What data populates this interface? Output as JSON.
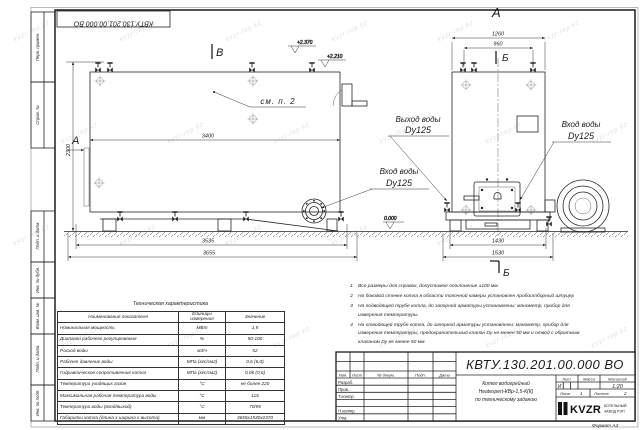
{
  "watermark": {
    "text": "kvzr-rep.kz"
  },
  "frame": {
    "stamp": "КВТУ.130.201.00.000  ВО",
    "margin_labels": [
      "Перв. примен.",
      "Справ. №",
      "Подп. и дата",
      "Инв. № дубл.",
      "Взам. инв. №",
      "Подп. и дата",
      "Инв. № подл."
    ],
    "format_label": "Формат  А3"
  },
  "drawing": {
    "sections": {
      "a_front": "А",
      "b_front": "В",
      "a_rear": "А",
      "b_top": "Б",
      "b_bottom": "Б"
    },
    "note_ref": "см. п. 2",
    "elevations": {
      "top1": "+2.370",
      "top2": "+2.210",
      "zero": "0.000"
    },
    "dims": {
      "front_width": "3400",
      "front_height": "2300",
      "front_base_inner": "3535",
      "front_base_outer": "3655",
      "rear_width": "1260",
      "rear_inner": "960",
      "rear_base_inner": "1430",
      "rear_base_outer": "1530"
    },
    "ports": {
      "outlet_line1": "Выход воды",
      "outlet_line2": "Dy125",
      "inlet_front_line1": "Вход воды",
      "inlet_front_line2": "Dy125",
      "inlet_rear_line1": "Вход воды",
      "inlet_rear_line2": "Dy125"
    }
  },
  "tech_table": {
    "title": "Техническая характеристика",
    "headers": [
      "Наименование показателя",
      "Единицы измерения",
      "Значение"
    ],
    "rows": [
      [
        "Номинальная мощность",
        "МВт",
        "1,5"
      ],
      [
        "Диапазон рабочего регулирования",
        "%",
        "50-100"
      ],
      [
        "Расход воды",
        "м3/ч",
        "52"
      ],
      [
        "Рабочее давление воды",
        "МПа (кгс/см2)",
        "0,6 (6,0)"
      ],
      [
        "Гидравлическое сопротивление котла",
        "МПа (кгс/см2)",
        "0,06 (0,6)"
      ],
      [
        "Температура уходящих газов",
        "°С",
        "не более 220"
      ],
      [
        "Максимальная рабочая температура воды",
        "°С",
        "115"
      ],
      [
        "Температура воды (вход/выход)",
        "°С",
        "70/95"
      ],
      [
        "Габариты котла (длина х ширина х высота)",
        "мм",
        "3655х1530х2370"
      ]
    ]
  },
  "notes": {
    "items": [
      "Все размеры для справок, допустимое отклонение ±100 мм.",
      "На боковой стенке котла в области топочной камеры установлен пробоотборный штуцер",
      "На подводящей трубе котла, до запорной арматуры установлены: манометр, прибор для измерения температуры.",
      "На отводящей трубе котла, до запорной арматуры установлены: манометр, прибор для измерения температуры, предохранительный клапан Dу не менее 50 мм и отвод с обратным клапаном Dу не менее 50 мм."
    ]
  },
  "title_block": {
    "doc_number": "КВТУ.130.201.00.000  ВО",
    "name_line1": "Котел водогрейный",
    "name_line2": "Heatexpert-КВр-1,5-К(К)",
    "name_line3": "по техническому заданию",
    "header_cols": [
      "Изм.",
      "Лист",
      "№ докум.",
      "Подп.",
      "Дата"
    ],
    "row_labels": [
      "Разраб.",
      "Пров.",
      "Т.контр.",
      "Н.контр.",
      "Утв."
    ],
    "lit_header": "Лит.",
    "mass_header": "Масса",
    "scale_header": "Масштаб",
    "lit_value": "И",
    "scale_value": "1:20",
    "sheet_label": "Лист",
    "sheet_value": "1",
    "sheets_label": "Листов",
    "sheets_value": "2",
    "logo_text": "KVZR",
    "logo_sub1": "КОТЕЛЬНЫЙ",
    "logo_sub2": "ЗАВОД РЭП"
  }
}
